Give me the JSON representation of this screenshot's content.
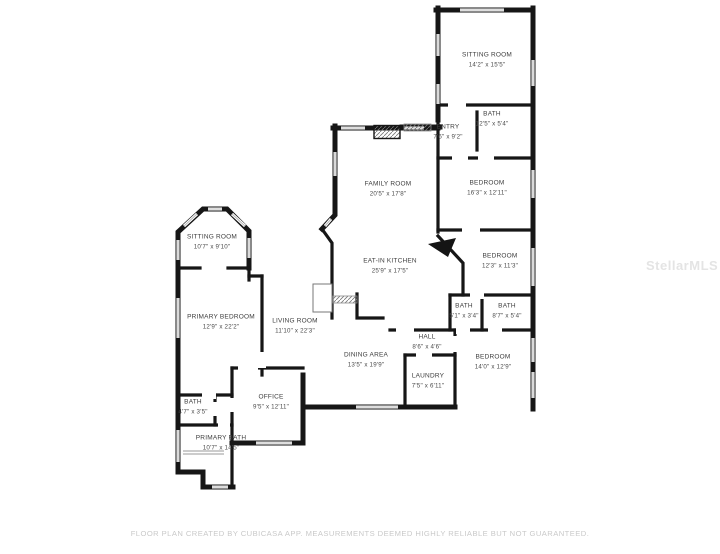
{
  "colors": {
    "wall": "#161616",
    "window": "#bdbdbd",
    "label_text": "#3d3d3d",
    "footer_text": "#c9c9c9",
    "watermark_text": "#e4e4e4",
    "background": "#ffffff"
  },
  "rooms": [
    {
      "name": "SITTING ROOM",
      "dims": "14'2\" x 15'5\""
    },
    {
      "name": "BATH",
      "dims": "12'5\" x 5'4\""
    },
    {
      "name": "ENTRY",
      "dims": "7'6\" x 9'2\""
    },
    {
      "name": "BEDROOM",
      "dims": "16'3\" x 12'11\""
    },
    {
      "name": "FAMILY ROOM",
      "dims": "20'5\" x 17'8\""
    },
    {
      "name": "EAT-IN KITCHEN",
      "dims": "25'9\" x 17'5\""
    },
    {
      "name": "BEDROOM",
      "dims": "12'3\" x 11'3\""
    },
    {
      "name": "BATH",
      "dims": "5'1\" x 3'4\""
    },
    {
      "name": "BATH",
      "dims": "8'7\" x 5'4\""
    },
    {
      "name": "HALL",
      "dims": "8'6\" x 4'6\""
    },
    {
      "name": "BEDROOM",
      "dims": "14'0\" x 12'9\""
    },
    {
      "name": "LAUNDRY",
      "dims": "7'5\" x 6'11\""
    },
    {
      "name": "DINING AREA",
      "dims": "13'5\" x 19'9\""
    },
    {
      "name": "SITTING ROOM",
      "dims": "10'7\" x 9'10\""
    },
    {
      "name": "PRIMARY BEDROOM",
      "dims": "12'9\" x 22'2\""
    },
    {
      "name": "LIVING ROOM",
      "dims": "11'10\" x 22'3\""
    },
    {
      "name": "OFFICE",
      "dims": "9'5\" x 12'11\""
    },
    {
      "name": "BATH",
      "dims": "4'7\" x 3'5\""
    },
    {
      "name": "PRIMARY BATH",
      "dims": "10'7\" x 14'5\""
    }
  ],
  "footer": {
    "text": "FLOOR PLAN CREATED BY CUBICASA APP. MEASUREMENTS DEEMED HIGHLY RELIABLE BUT NOT GUARANTEED."
  },
  "watermark": {
    "text": "StellarMLS"
  }
}
